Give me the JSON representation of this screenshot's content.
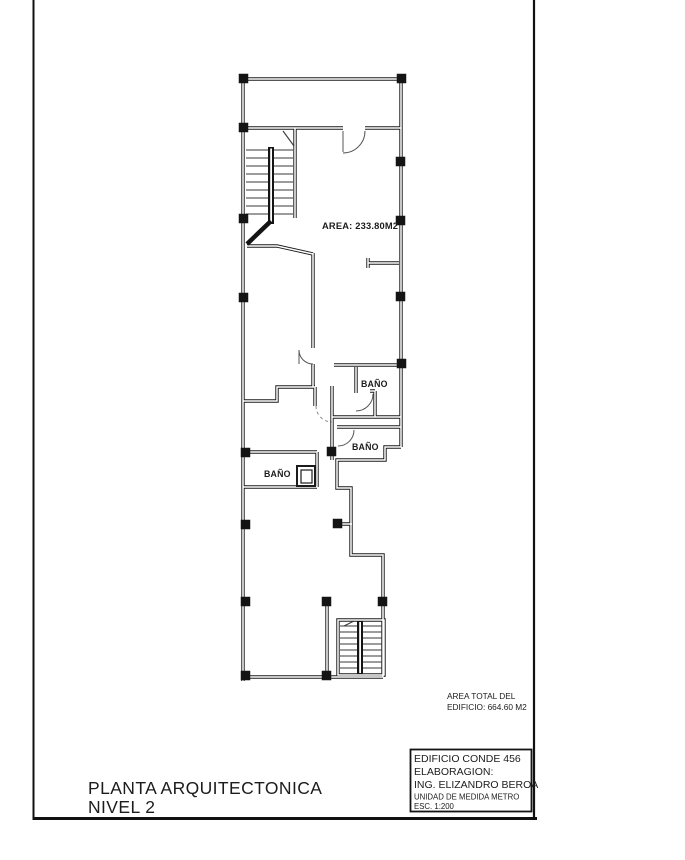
{
  "sheet": {
    "plan": {
      "area_label": "AREA: 233.80M2",
      "bathroom_label": "BAÑO"
    },
    "total_area": {
      "line1": "AREA TOTAL DEL",
      "line2": "EDIFICIO: 664.60 M2"
    },
    "title_block": {
      "building": "EDIFICIO CONDE 456",
      "elaboration_label": "ELABORAGION:",
      "engineer": "ING. ELIZANDRO BEROA",
      "unit": "UNIDAD DE MEDIDA METRO",
      "scale": "ESC. 1:200"
    },
    "title": {
      "line1": "PLANTA ARQUITECTONICA",
      "line2": "NIVEL 2"
    },
    "colors": {
      "ink": "#1b1b1b",
      "paper": "#ffffff"
    }
  }
}
